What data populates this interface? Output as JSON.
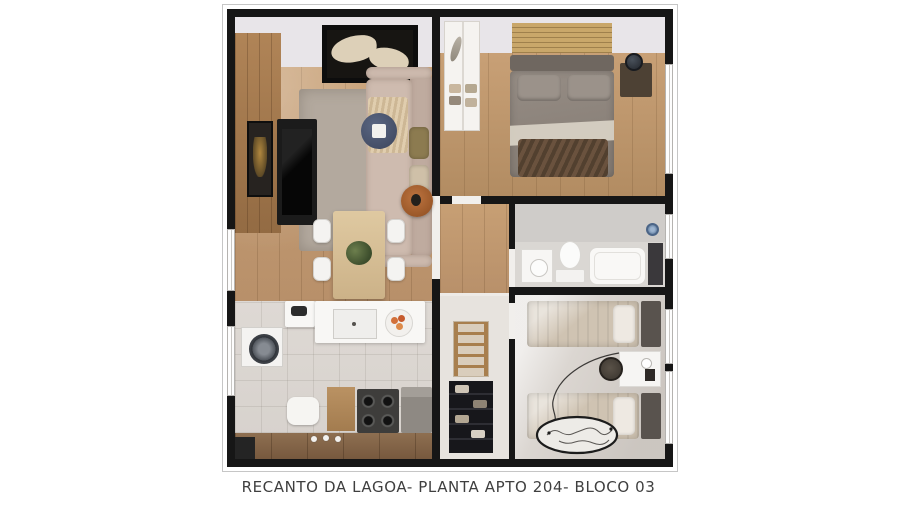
{
  "caption": {
    "text": "RECANTO DA LAGOA- PLANTA APTO 204- BLOCO 03"
  },
  "palette": {
    "background": "#ffffff",
    "wall_black": "#161616",
    "wood_floor": "#c79f74",
    "tile_floor": "#dcd8d3",
    "bedroom2_floor": "#dbd6d1",
    "rug_gray": "#b3a99e",
    "sofa_beige": "#cebbaf",
    "bedding_gray": "#968d85",
    "bedding_beige": "#cfc3b2",
    "throw_brown": "#5c4736",
    "counter_white": "#f8f7f5",
    "cabinet_wood": "#8e6f51",
    "accent_terracotta": "#a85f2e",
    "plant_green": "#4a5d3a",
    "shower_blue": "#6d89aa",
    "caption_text": "#3f3f3f"
  },
  "scene": {
    "type": "apartment-floor-plan-3d-render",
    "rooms": [
      {
        "name": "living-dining-room",
        "furniture": [
          "l-shaped-sofa",
          "throw-blanket",
          "pillows",
          "round-side-table",
          "area-rug",
          "tv-console",
          "tv",
          "wall-art",
          "wood-accent-panel",
          "ceiling-light-panel",
          "round-coffee-table",
          "dining-table",
          "dining-chairs-x4",
          "potted-plant"
        ]
      },
      {
        "name": "kitchen-laundry",
        "furniture": [
          "sink-counter",
          "sink",
          "fruit-bowl",
          "kettle",
          "washing-machine",
          "stool",
          "wood-cabinet",
          "cooktop-stove",
          "refrigerator",
          "lower-wood-counter",
          "dishes"
        ]
      },
      {
        "name": "master-bedroom",
        "furniture": [
          "double-bed",
          "headboard",
          "pillows-x2",
          "gray-duvet",
          "white-sheet-fold",
          "brown-throw",
          "nightstand",
          "table-lamp",
          "wardrobe-closet",
          "folded-clothes",
          "slat-wall-panel"
        ]
      },
      {
        "name": "bathroom",
        "furniture": [
          "vanity-sink",
          "toilet",
          "bathtub",
          "shower-glass",
          "shower-head"
        ]
      },
      {
        "name": "bedroom-2",
        "furniture": [
          "single-bed-top",
          "single-bed-bottom",
          "pillows",
          "headboards-x2",
          "desk",
          "desk-chair",
          "cup",
          "photo-frame",
          "round-map-rug",
          "cord-line"
        ]
      },
      {
        "name": "hallway-closet-nook",
        "furniture": [
          "ladder-rack",
          "black-open-shelf",
          "folded-clothes"
        ]
      }
    ],
    "windows": [
      "living-left",
      "kitchen-left",
      "master-right",
      "bathroom-right",
      "bedroom2-right-a",
      "bedroom2-right-b"
    ]
  }
}
